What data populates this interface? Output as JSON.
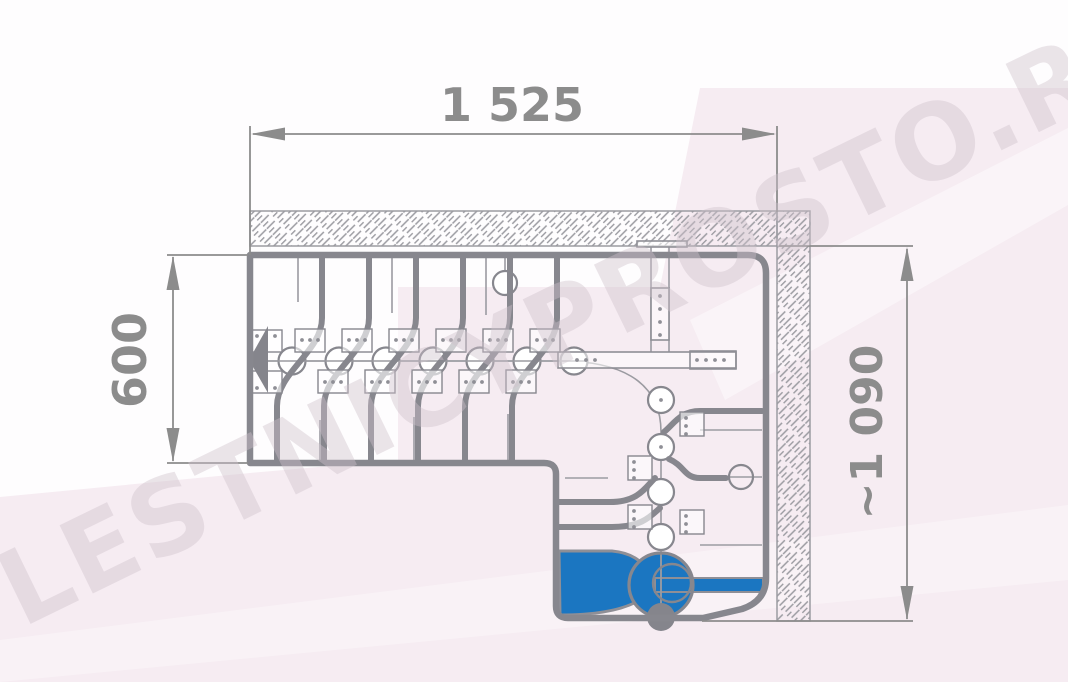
{
  "page": {
    "type": "technical-drawing",
    "subject": "L-shaped modular staircase plan view with highlighted first step"
  },
  "watermark": {
    "text": "LESTNICYPROSTO.RU",
    "color": "#cfc2cc"
  },
  "dimensions": {
    "top_width": {
      "label": "1 525"
    },
    "left_depth": {
      "label": "600"
    },
    "right_depth": {
      "label": "~1 090"
    }
  },
  "colors": {
    "accent_blue": "#1b76c1",
    "line_gray": "#87878e",
    "thin_gray": "#9b9ba1",
    "dim_gray": "#8c8c8c",
    "hatch_gray": "#9b9ba1",
    "background_pink": "#f6ecf2"
  }
}
